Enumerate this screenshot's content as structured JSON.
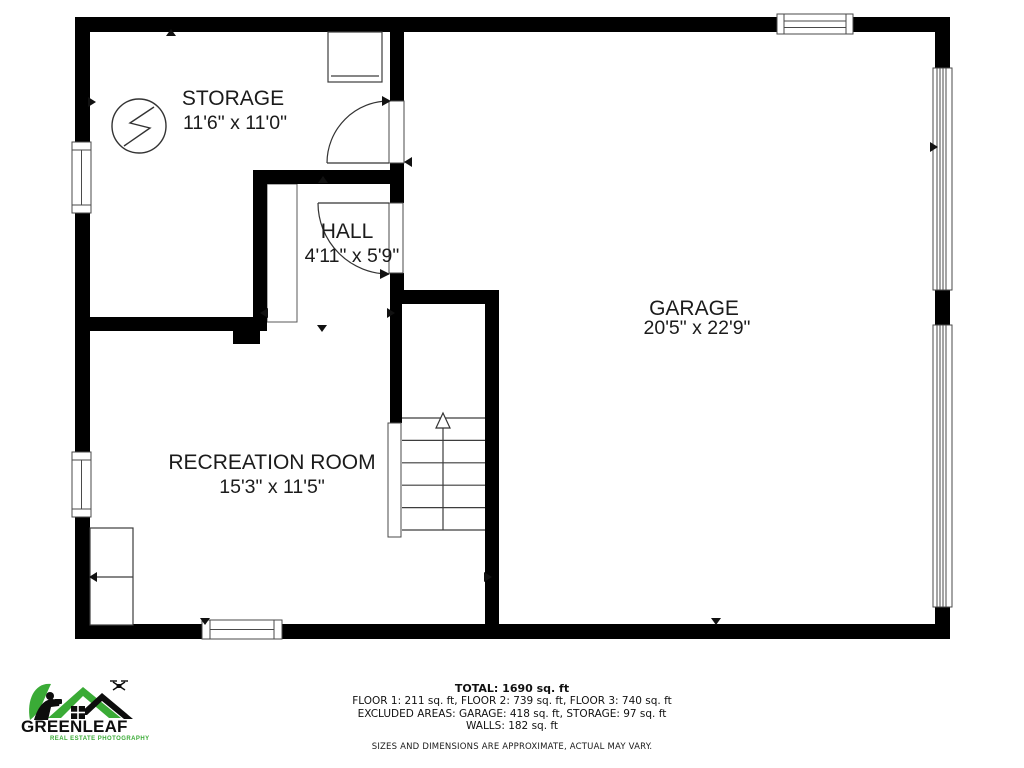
{
  "rooms": {
    "storage": {
      "name": "STORAGE",
      "dims": "11'6\" x 11'0\""
    },
    "hall": {
      "name": "HALL",
      "dims": "4'11\" x 5'9\""
    },
    "garage": {
      "name": "GARAGE",
      "dims": "20'5\" x 22'9\""
    },
    "recreation": {
      "name": "RECREATION ROOM",
      "dims": "15'3\" x 11'5\""
    }
  },
  "summary": {
    "total": "TOTAL: 1690 sq. ft",
    "floors": "FLOOR 1: 211 sq. ft, FLOOR 2: 739 sq. ft, FLOOR 3: 740 sq. ft",
    "excluded": "EXCLUDED AREAS: GARAGE: 418 sq. ft, STORAGE: 97 sq. ft",
    "walls": "WALLS: 182 sq. ft",
    "disclaimer": "SIZES AND DIMENSIONS ARE APPROXIMATE, ACTUAL MAY VARY."
  },
  "logo": {
    "brand": "GREENLEAF",
    "tagline": "REAL ESTATE PHOTOGRAPHY"
  },
  "colors": {
    "wall": "#000000",
    "thin_line": "#4a4a4a",
    "logo_green": "#3aab36",
    "background": "#ffffff"
  }
}
